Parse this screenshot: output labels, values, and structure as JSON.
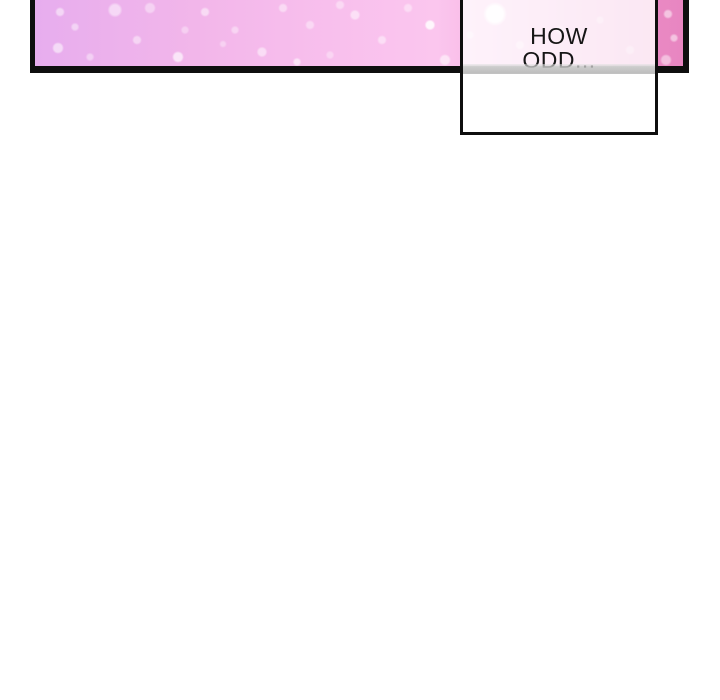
{
  "scene": {
    "kind": "webtoon-comic-strip-fragment",
    "page_background": "#ffffff"
  },
  "panel": {
    "description": "sparkle gradient panel, cut off at top of viewport",
    "border_color": "#0e0e0e",
    "gradient_stops": [
      "#e7adee",
      "#f8bfed",
      "#fbc6ee",
      "#f2a6d9",
      "#e886c1"
    ],
    "sparkle_color": "#ffffff"
  },
  "speech_box": {
    "lines": [
      "HOW",
      "ODD..."
    ],
    "full_text": "HOW ODD...",
    "fill": "rgba(255,255,255,0.8)",
    "border_color": "#0e0e0e",
    "text_color": "#161616"
  }
}
